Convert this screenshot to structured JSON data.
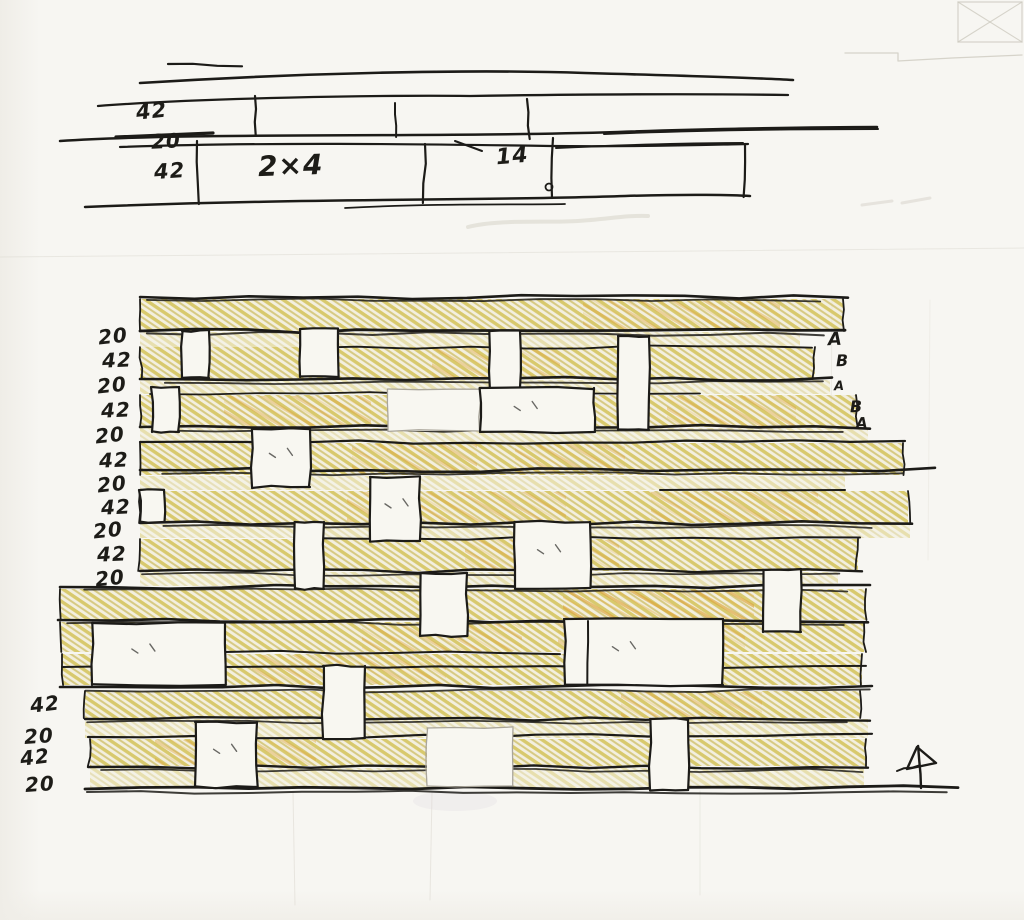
{
  "artwork": {
    "kind": "hand-drawn wall cladding sketch",
    "subject": "stacked horizontal plank wall elevation with spacer blocks",
    "medium": "ink pen with ochre colored-pencil hatching on white paper"
  },
  "top_detail": {
    "dim_top_board": "42",
    "dim_gap": "20",
    "dim_bottom_board": "42",
    "board_note": "2×4",
    "dim_right": "14"
  },
  "elevation": {
    "left_dims": [
      "20",
      "42",
      "20",
      "42",
      "20",
      "42",
      "20",
      "42",
      "20",
      "42",
      "20"
    ],
    "lower_left_dims": [
      "42",
      "20",
      "42",
      "20"
    ],
    "right_course_labels": [
      "A",
      "B",
      "A",
      "B",
      "A"
    ],
    "colors": {
      "ink": "#1c1b18",
      "hatch_light": "#d8c96d",
      "hatch_mid": "#cfc06a",
      "hatch_orange": "#dca63d",
      "hatch_orange2": "#e2b14e",
      "plank_tint": "#efe8cb",
      "block_fill": "#f8f7f1",
      "paper": "#f7f6f2",
      "pencil_faint": "#cdcabf"
    }
  }
}
